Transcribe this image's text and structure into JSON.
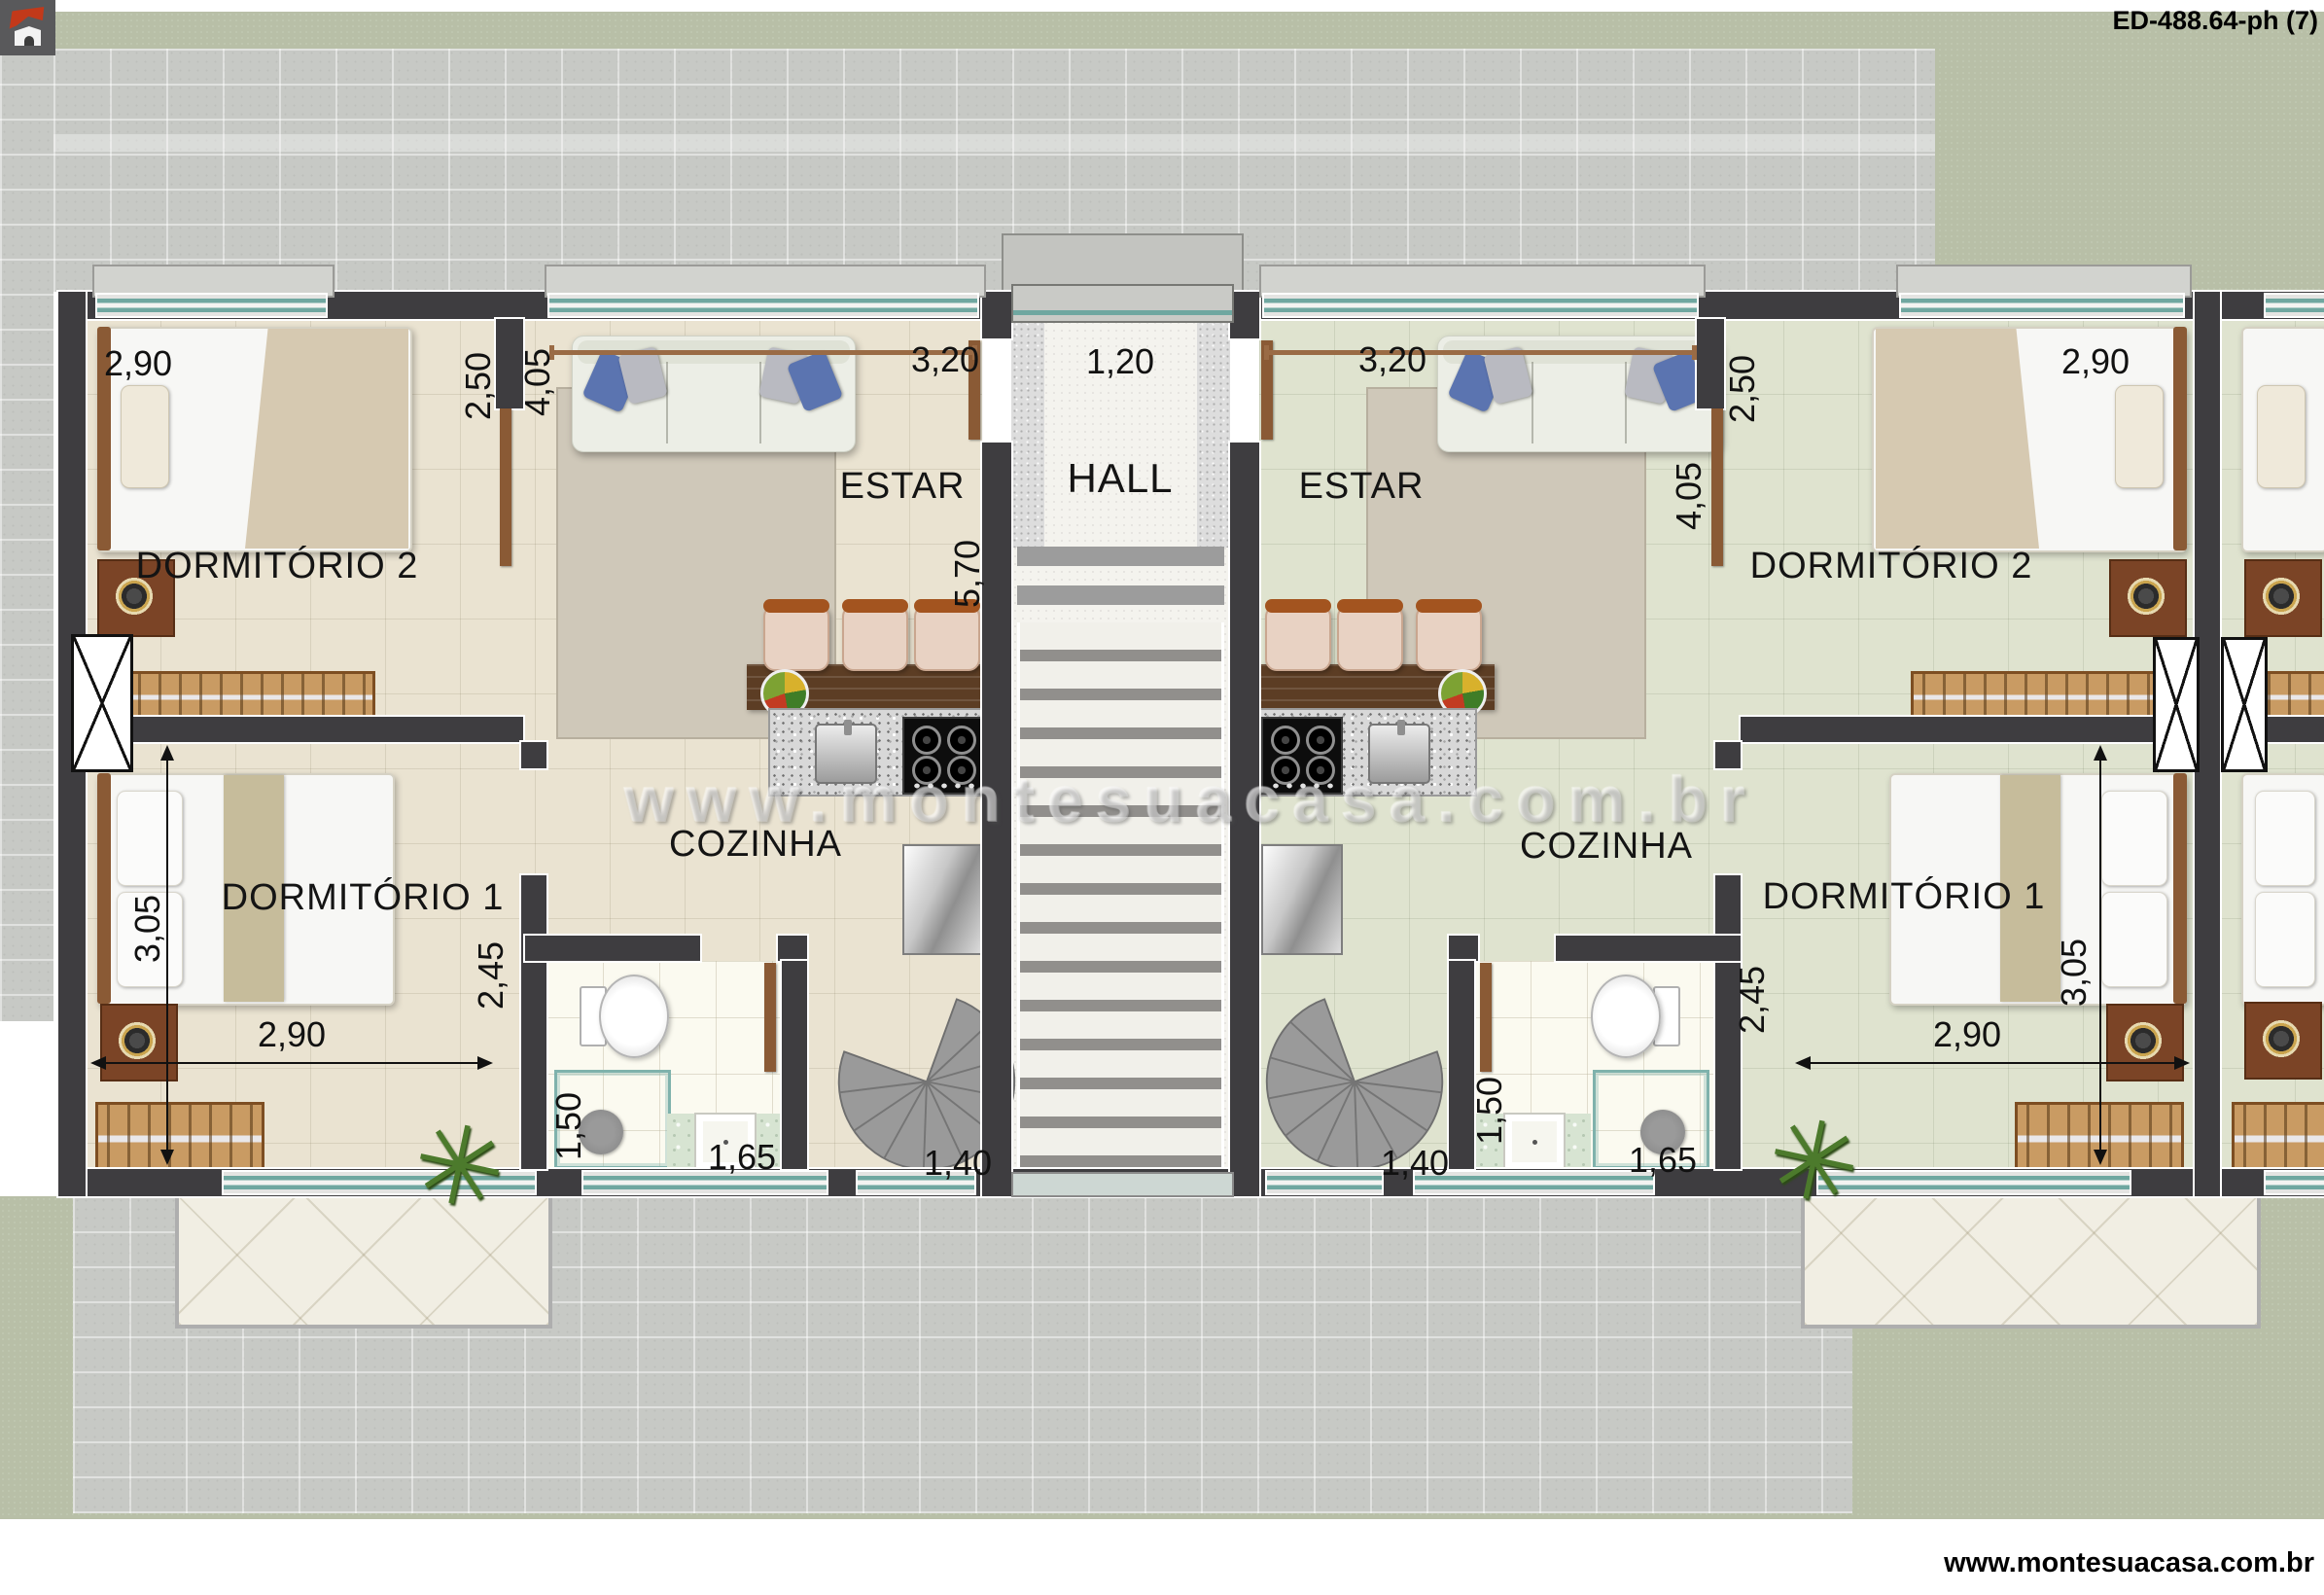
{
  "header": {
    "plan_code": "ED-488.64-ph (7)"
  },
  "branding": {
    "logo_icon": "monte-sua-casa-house-logo",
    "watermark_url": "www.montesuacasa.com.br",
    "footer_url": "www.montesuacasa.com.br"
  },
  "rooms": {
    "hall": "HALL",
    "estar": "ESTAR",
    "cozinha": "COZINHA",
    "dormitorio1": "DORMITÓRIO 1",
    "dormitorio2": "DORMITÓRIO 2"
  },
  "dims": {
    "hall_width": "1,20",
    "dorm2_width": "2,90",
    "dorm2_depth": "2,50",
    "estar_width": "3,20",
    "estar_depth": "4,05",
    "unit_depth": "5,70",
    "dorm1_width": "2,90",
    "dorm1_depth": "3,05",
    "corridor_depth": "2,45",
    "bath_width": "1,50",
    "bath_length": "1,65",
    "stair_width": "1,40"
  },
  "colors": {
    "wall": "#3e3d40",
    "window_glass": "#6fa7a0",
    "dimension_line_brown": "#9a6b45",
    "floor_left_unit": "#eae3d1",
    "floor_right_unit": "#dfe3cf",
    "grass": "#b8bfa7",
    "pavement": "#c7c9c5"
  }
}
